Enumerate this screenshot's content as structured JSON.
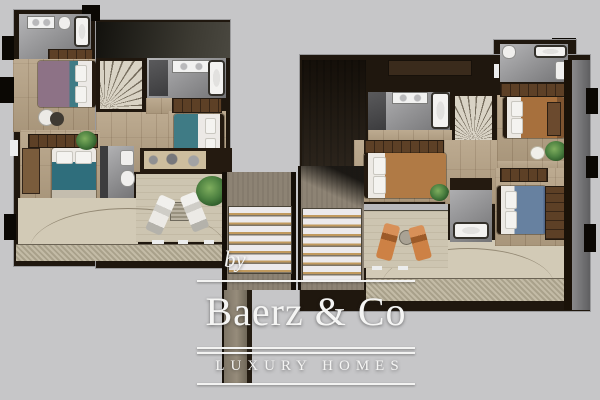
{
  "logo": {
    "by": "by",
    "brand": "Baerz & Co",
    "tagline": "LUXURY HOMES"
  },
  "colors": {
    "bg": "#c6c6c8",
    "wall": "#1f170e",
    "wood": "#b5a184",
    "tile_a": "#b6b6b8",
    "tile_b": "#737375",
    "terrace": "#cdc5b1",
    "brown_mid": "#8d8374",
    "gold": "#c19a5e",
    "logo_white": "#f5f5f4",
    "teal": "#3f7b85",
    "mauve": "#8d7286",
    "brown_bed": "#a7703d",
    "blue_bed": "#6781a0",
    "orange": "#cd8145",
    "green": "#4c8040"
  },
  "diagram": {
    "type": "floor-plan",
    "description": "Two rendered top-view floor plans of a luxury home shown side by side on a grey background, joined by louvered pergola panels, with the Baerz & Co Luxury Homes watermark at bottom centre",
    "left_plan": {
      "rooms": [
        "bathroom-ensuite",
        "bedroom-mauve",
        "winder-staircase",
        "bathroom-double-sink",
        "bedroom-teal",
        "bedroom-lower",
        "shower-room",
        "kitchen-counter",
        "terrace-with-white-loungers",
        "balcony-with-decking"
      ]
    },
    "right_plan": {
      "rooms": [
        "bathroom-top",
        "bedroom-brown",
        "winder-staircase",
        "bathroom-double-sink",
        "bedroom-brown-2",
        "shower-room",
        "bedroom-blue",
        "terrace-with-orange-loungers",
        "balcony-with-decking"
      ]
    },
    "middle": {
      "elements": [
        "louvered-pergola-left",
        "louvered-pergola-right",
        "service-column"
      ]
    }
  }
}
